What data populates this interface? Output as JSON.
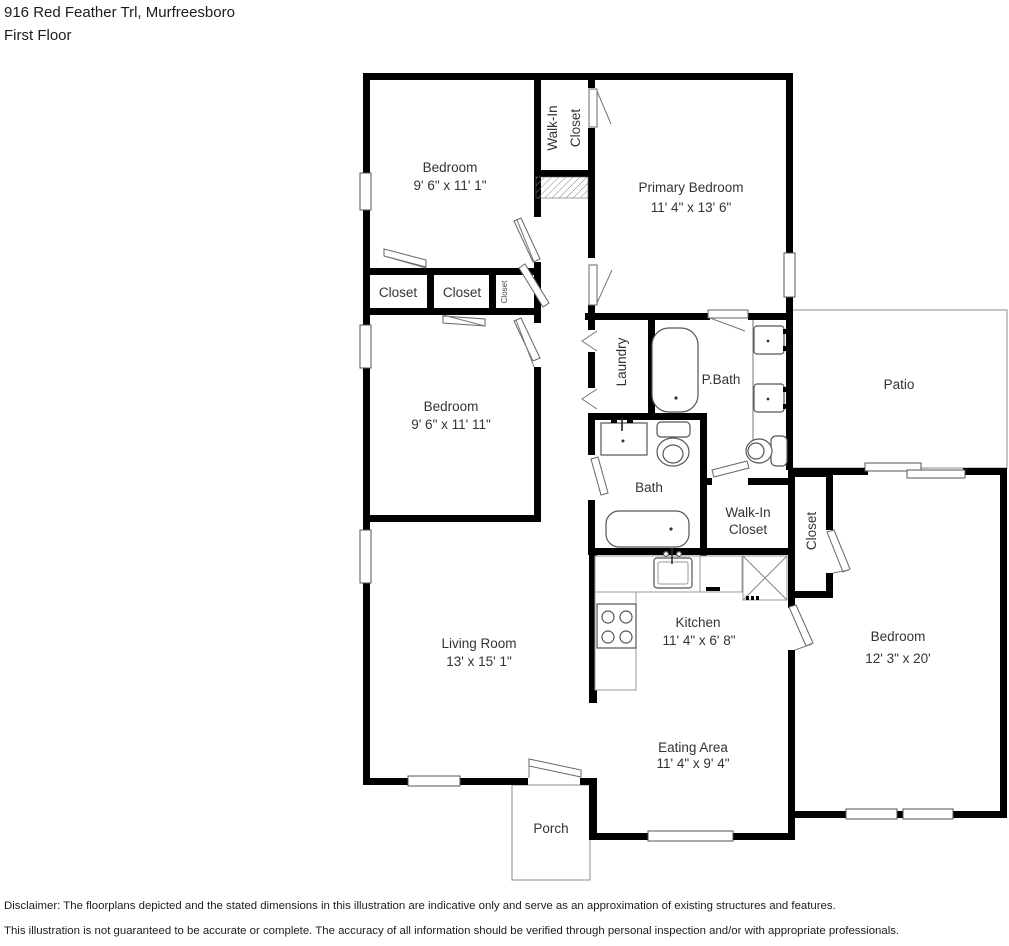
{
  "header": {
    "address": "916 Red Feather Trl, Murfreesboro",
    "floor": "First Floor"
  },
  "rooms": {
    "bedroom1": {
      "name": "Bedroom",
      "dims": "9' 6\" x 11' 1\""
    },
    "walkin_top": {
      "line1": "Walk-In",
      "line2": "Closet"
    },
    "primary": {
      "name": "Primary Bedroom",
      "dims": "11' 4\" x 13' 6\""
    },
    "closet1": {
      "name": "Closet"
    },
    "closet2": {
      "name": "Closet"
    },
    "closet3": {
      "name": "Closet"
    },
    "bedroom2": {
      "name": "Bedroom",
      "dims": "9' 6\" x 11' 11\""
    },
    "laundry": {
      "name": "Laundry"
    },
    "pbath": {
      "name": "P.Bath"
    },
    "patio": {
      "name": "Patio"
    },
    "bath": {
      "name": "Bath"
    },
    "walkin_lower": {
      "line1": "Walk-In",
      "line2": "Closet"
    },
    "closet4": {
      "name": "Closet"
    },
    "living": {
      "name": "Living Room",
      "dims": "13' x 15' 1\""
    },
    "kitchen": {
      "name": "Kitchen",
      "dims": "11' 4\" x 6' 8\""
    },
    "bedroom3": {
      "name": "Bedroom",
      "dims": "12' 3\" x 20'"
    },
    "eating": {
      "name": "Eating Area",
      "dims": "11' 4\" x 9' 4\""
    },
    "porch": {
      "name": "Porch"
    }
  },
  "footer": {
    "line1": "Disclaimer: The floorplans depicted and the stated dimensions in this illustration are indicative only and serve as an approximation of existing structures and features.",
    "line2": "This illustration is not guaranteed to be accurate or complete. The accuracy of all information should be verified through personal inspection and/or with appropriate professionals."
  }
}
